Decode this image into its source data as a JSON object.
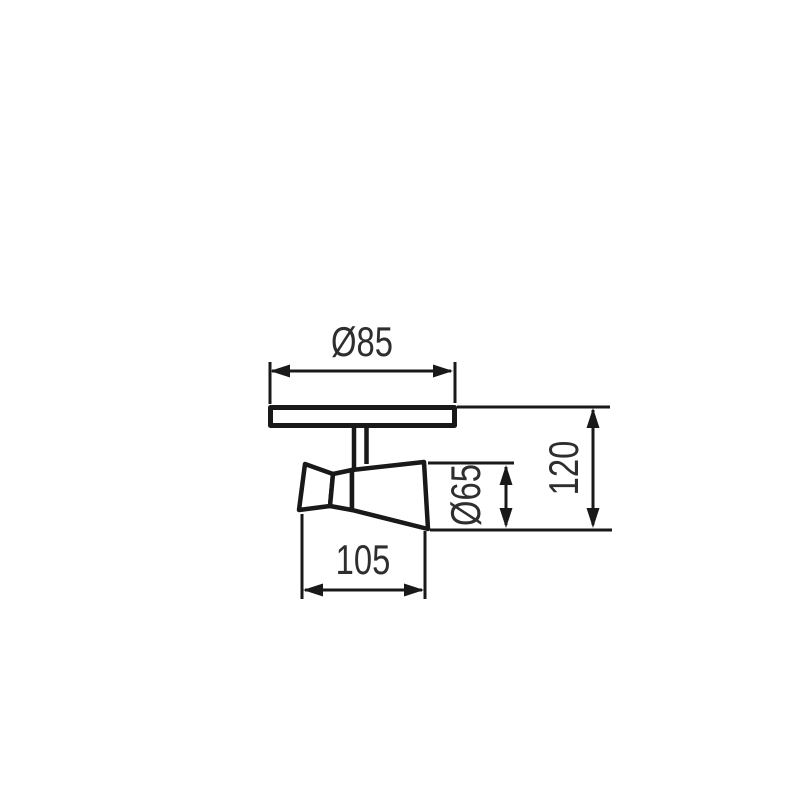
{
  "labels": {
    "plate_diameter": "Ø85",
    "body_width": "105",
    "head_diameter": "Ø65",
    "overall_height": "120"
  },
  "colors": {
    "background": "#ffffff",
    "line": "#191919",
    "text": "#2e2e2e"
  }
}
